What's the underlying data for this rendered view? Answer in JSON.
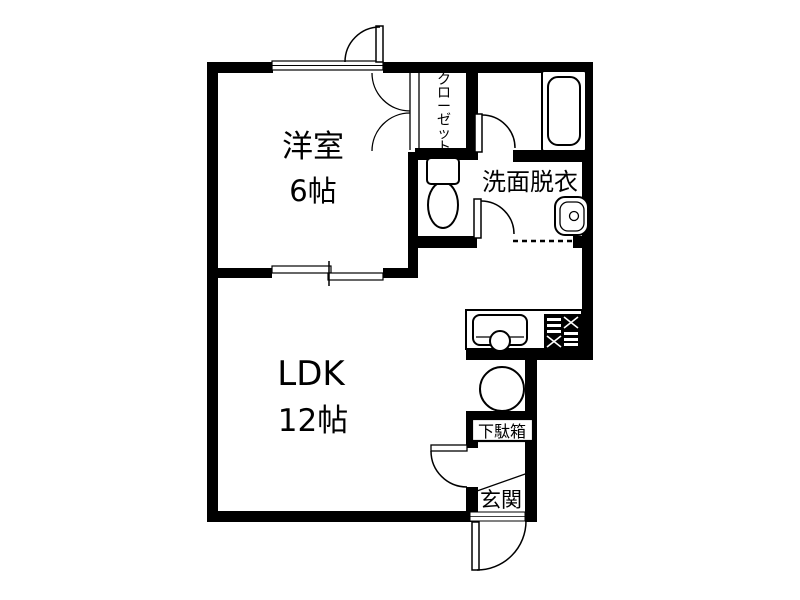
{
  "plan": {
    "title": "floor-plan",
    "rooms": {
      "western_room": {
        "name": "洋室",
        "size": "6帖"
      },
      "ldk": {
        "name": "LDK",
        "size": "12帖"
      },
      "closet": {
        "name": "クローゼット"
      },
      "washroom": {
        "name": "洗面脱衣"
      },
      "shoe_cabinet": {
        "name": "下駄箱"
      },
      "entrance": {
        "name": "玄関"
      }
    },
    "fixtures": {
      "bathtub": "bathtub-icon",
      "toilet": "toilet-icon",
      "washbasin": "washbasin-icon",
      "kitchen_sink": "kitchen-sink-icon",
      "stove": "stove-icon",
      "round_table": "round-table-icon"
    },
    "colors": {
      "wall": "#000000",
      "background": "#ffffff",
      "line": "#000000"
    }
  }
}
